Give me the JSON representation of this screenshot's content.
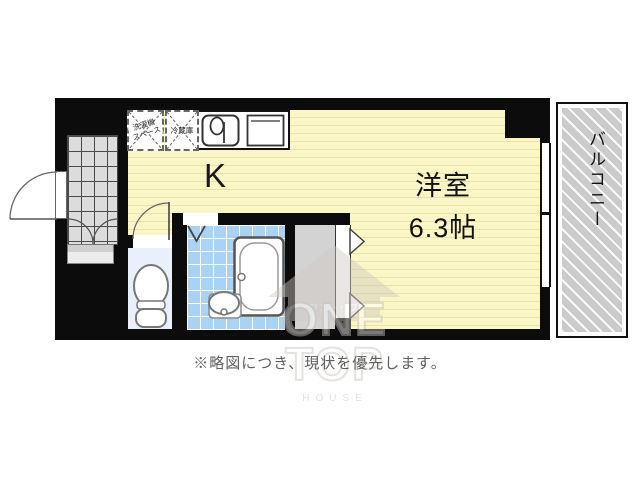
{
  "floorplan": {
    "rooms": {
      "kitchen": {
        "label": "K"
      },
      "main_room": {
        "name": "洋室",
        "size": "6.3帖"
      },
      "balcony": {
        "label": "バルコニー"
      },
      "appliance_spaces": {
        "washer_line1": "洗濯機",
        "washer_line2": "スペース",
        "fridge": "冷蔵庫"
      }
    },
    "caption": "※略図につき、現状を優先します。",
    "watermark": {
      "katakana": "ワントップ",
      "word1": "ONE",
      "word2": "TOP",
      "word3": "HOUSE"
    },
    "colors": {
      "wall": "#0c0c0c",
      "room_fill": "#fbf6c5",
      "room_stripe": "#eae2a6",
      "bath_tile": "#a9d2f3",
      "toilet_floor": "#eaf0fb",
      "entrance_tile": "#dcdcdc",
      "closet_fill": "#d3d3d3",
      "balcony_fill": "#cbcbcb",
      "caption_color": "#606060"
    }
  }
}
